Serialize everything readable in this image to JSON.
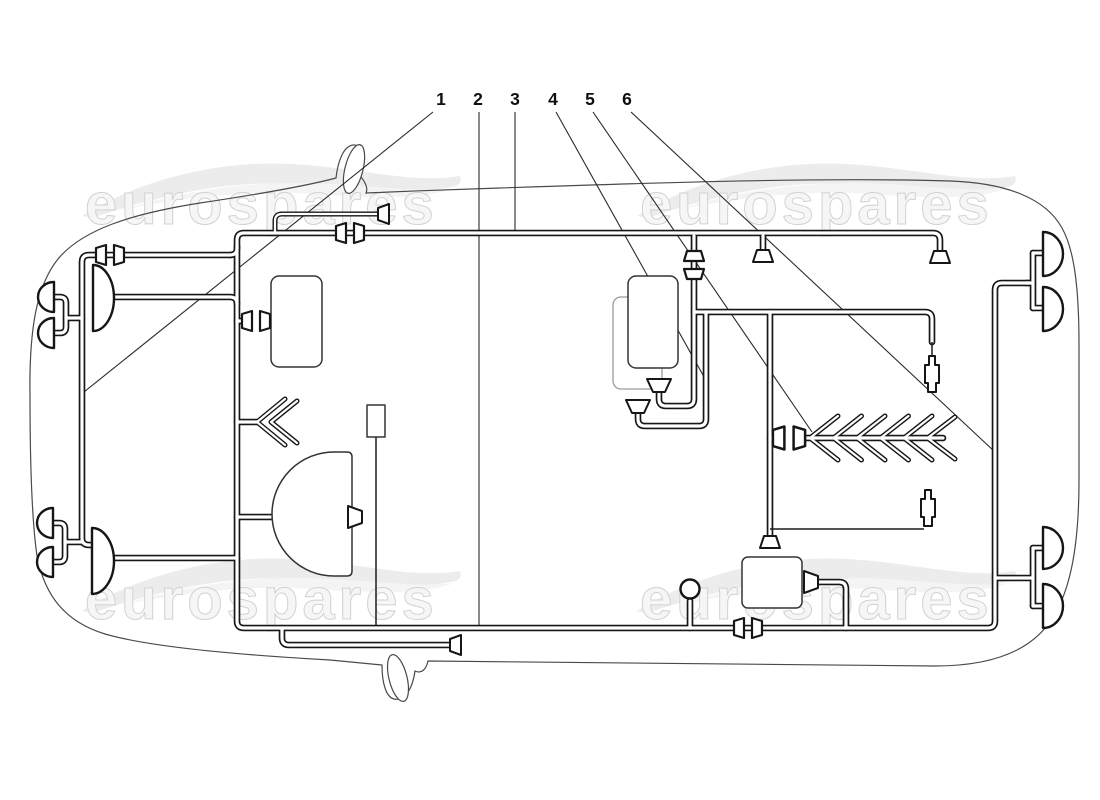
{
  "diagram": {
    "background": "#ffffff",
    "line_color": "#161616",
    "outline_color": "#4a4a4a",
    "description": "Car electrical system wiring harness parts diagram, plan view"
  },
  "watermark": {
    "text": "eurospares",
    "fill": "#f6f6f6",
    "stroke": "#d2d2d2"
  },
  "callouts": [
    {
      "label": "1",
      "x": 441,
      "y": 105,
      "line": {
        "x1": 433,
        "y1": 112,
        "x2": 84,
        "y2": 392
      }
    },
    {
      "label": "2",
      "x": 478,
      "y": 105,
      "line": {
        "x1": 479,
        "y1": 112,
        "x2": 479,
        "y2": 626
      }
    },
    {
      "label": "3",
      "x": 515,
      "y": 105,
      "line": {
        "x1": 515,
        "y1": 112,
        "x2": 515,
        "y2": 230
      }
    },
    {
      "label": "4",
      "x": 553,
      "y": 105,
      "line": {
        "x1": 556,
        "y1": 112,
        "x2": 708,
        "y2": 384
      }
    },
    {
      "label": "5",
      "x": 590,
      "y": 105,
      "line": {
        "x1": 593,
        "y1": 112,
        "x2": 812,
        "y2": 432
      }
    },
    {
      "label": "6",
      "x": 627,
      "y": 105,
      "line": {
        "x1": 631,
        "y1": 112,
        "x2": 995,
        "y2": 452
      }
    }
  ]
}
